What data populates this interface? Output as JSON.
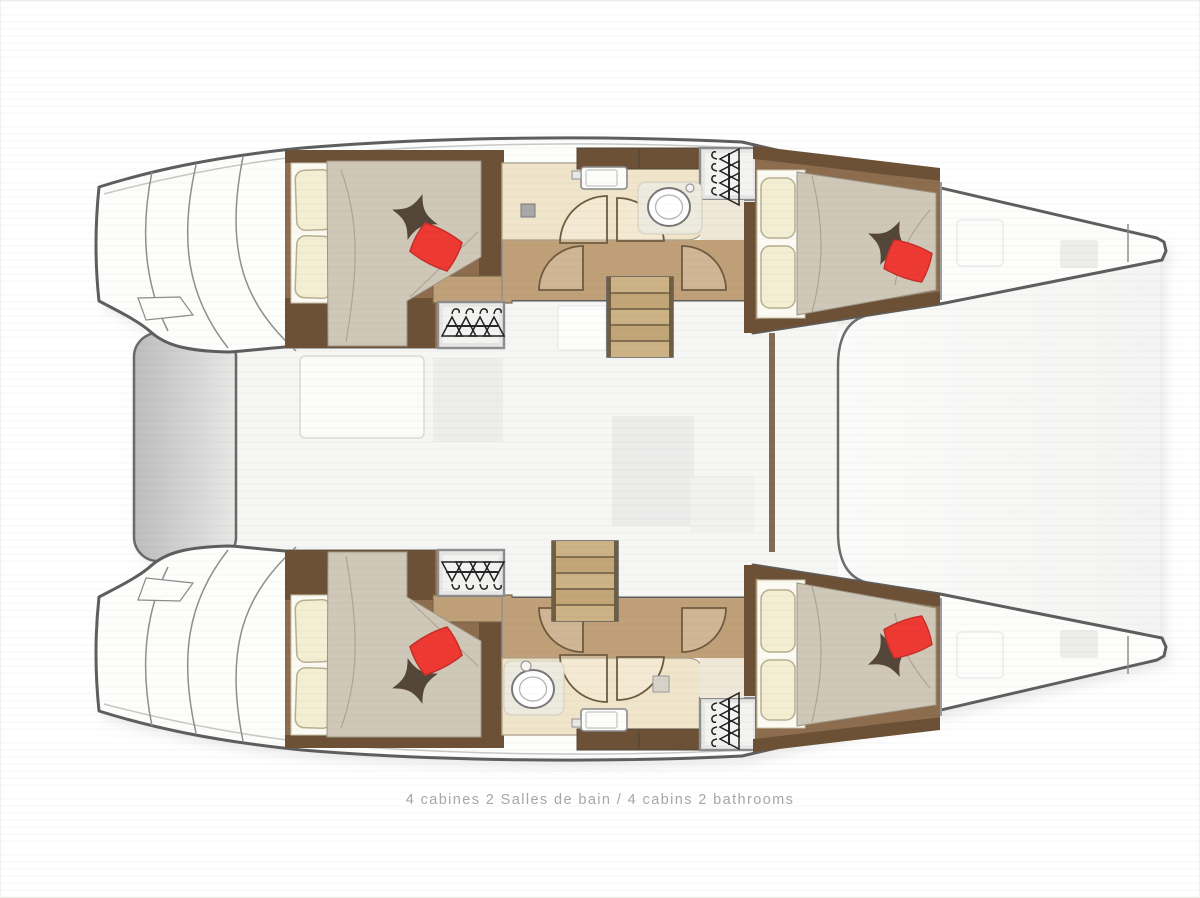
{
  "caption": {
    "text": "4 cabines 2 Salles de bain / 4 cabins 2 bathrooms"
  },
  "layout_summary": {
    "cabins": 4,
    "bathrooms": 2
  },
  "colors": {
    "outline": "#5e5e5e",
    "white": "#fdfdfc",
    "shadow": "#d3d3d2",
    "wood": "#c0a078",
    "wood_mid": "#8d6d4e",
    "wood_dark": "#6d5136",
    "cream": "#f0e5ca",
    "duvet": "#cfc8b8",
    "pillow": "#f4efd3",
    "sheet": "#fbfaf3",
    "red": "#ee3a33",
    "cushion": "#544638",
    "locker": "#e7e7e6",
    "hanger": "#222222",
    "ghost": "#ededec",
    "caption": "#a6a6a6"
  }
}
